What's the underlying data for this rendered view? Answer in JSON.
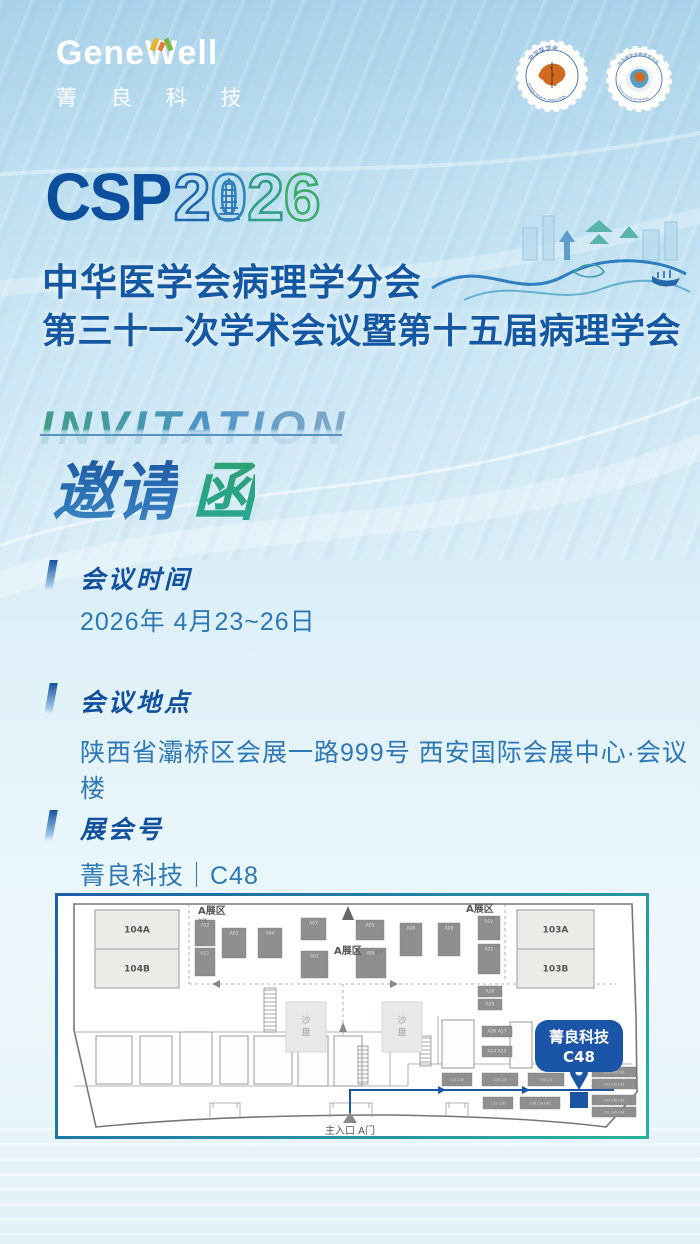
{
  "brand": {
    "logo_text": "GeneWell",
    "logo_sub": "菁 良 科 技"
  },
  "seals": {
    "left": {
      "top_text": "中华医学会",
      "arc_text": "CHINESE MEDICAL ASSOCIATION"
    },
    "right": {
      "top_text": "中华医学会病理学分会",
      "arc_text": "Chinese Society of Pathology"
    }
  },
  "hero": {
    "csp_text": "CSP",
    "year": [
      "2",
      "0",
      "2",
      "6"
    ],
    "title_line1": "中华医学会病理学分会",
    "title_line2": "第三十一次学术会议暨第十五届病理学会",
    "invitation_en": "INVITATION",
    "invitation_zh_1": "邀请",
    "invitation_zh_2": "函"
  },
  "sections": [
    {
      "title": "会议时间",
      "content": "2026年 4月23~26日"
    },
    {
      "title": "会议地点",
      "content": "陕西省灞桥区会展一路999号 西安国际会展中心·会议楼"
    },
    {
      "title": "展会号",
      "content": "菁良科技｜C48"
    }
  ],
  "map": {
    "zones": [
      {
        "text": "A展区",
        "sub": "左侧"
      },
      {
        "text": "A展区",
        "sub": "右侧"
      },
      {
        "text": "A展区",
        "sub": "展厅"
      }
    ],
    "rooms": [
      {
        "label": "104A",
        "x": 37,
        "y": 14,
        "w": 84,
        "h": 39
      },
      {
        "label": "104B",
        "x": 37,
        "y": 53,
        "w": 84,
        "h": 39
      },
      {
        "label": "103A",
        "x": 459,
        "y": 14,
        "w": 77,
        "h": 39
      },
      {
        "label": "103B",
        "x": 459,
        "y": 53,
        "w": 77,
        "h": 39
      }
    ],
    "booths_a": [
      {
        "x": 137,
        "y": 24,
        "w": 20,
        "h": 26,
        "l": "A12"
      },
      {
        "x": 137,
        "y": 52,
        "w": 20,
        "h": 28,
        "l": "A11"
      },
      {
        "x": 164,
        "y": 32,
        "w": 24,
        "h": 30,
        "l": "A03"
      },
      {
        "x": 200,
        "y": 32,
        "w": 24,
        "h": 30,
        "l": "A04"
      },
      {
        "x": 243,
        "y": 22,
        "w": 25,
        "h": 22,
        "l": "A07"
      },
      {
        "x": 243,
        "y": 55,
        "w": 27,
        "h": 27,
        "l": "A01"
      },
      {
        "x": 298,
        "y": 24,
        "w": 28,
        "h": 20,
        "l": "A05"
      },
      {
        "x": 298,
        "y": 52,
        "w": 30,
        "h": 30,
        "l": "A06"
      },
      {
        "x": 342,
        "y": 27,
        "w": 22,
        "h": 33,
        "l": "A08"
      },
      {
        "x": 380,
        "y": 27,
        "w": 22,
        "h": 33,
        "l": "A09"
      },
      {
        "x": 420,
        "y": 20,
        "w": 22,
        "h": 24,
        "l": "A02"
      },
      {
        "x": 420,
        "y": 48,
        "w": 22,
        "h": 30,
        "l": "A21"
      },
      {
        "x": 420,
        "y": 90,
        "w": 24,
        "h": 11,
        "l": "A30"
      },
      {
        "x": 420,
        "y": 103,
        "w": 24,
        "h": 11,
        "l": "A29"
      },
      {
        "x": 424,
        "y": 130,
        "w": 30,
        "h": 11,
        "l": "A26 A27"
      },
      {
        "x": 424,
        "y": 150,
        "w": 30,
        "h": 11,
        "l": "A24 A25"
      }
    ],
    "booths_c": [
      {
        "x": 384,
        "y": 177,
        "w": 30,
        "h": 13,
        "l": "C01 C02"
      },
      {
        "x": 424,
        "y": 177,
        "w": 36,
        "h": 13,
        "l": "C04 C05"
      },
      {
        "x": 470,
        "y": 177,
        "w": 36,
        "h": 13,
        "l": "C30 C31"
      },
      {
        "x": 534,
        "y": 171,
        "w": 44,
        "h": 10,
        "l": "C14 C45 C46"
      },
      {
        "x": 534,
        "y": 183,
        "w": 44,
        "h": 10,
        "l": "C43 C45 C47"
      },
      {
        "x": 425,
        "y": 201,
        "w": 30,
        "h": 12,
        "l": "C35 C36"
      },
      {
        "x": 462,
        "y": 201,
        "w": 40,
        "h": 12,
        "l": "C38 C39 C40"
      },
      {
        "x": 534,
        "y": 199,
        "w": 44,
        "h": 10,
        "l": "C47 C48 C43"
      },
      {
        "x": 534,
        "y": 211,
        "w": 44,
        "h": 10,
        "l": "C41 C42 C44"
      }
    ],
    "sand_tables": [
      {
        "x": 228,
        "y": 106,
        "w": 40,
        "h": 50
      },
      {
        "x": 324,
        "y": 106,
        "w": 40,
        "h": 50
      }
    ],
    "sand_label": "沙盘",
    "structures": [
      {
        "x": 38,
        "y": 140,
        "w": 36,
        "h": 48
      },
      {
        "x": 82,
        "y": 140,
        "w": 32,
        "h": 48
      },
      {
        "x": 122,
        "y": 136,
        "w": 32,
        "h": 52
      },
      {
        "x": 162,
        "y": 140,
        "w": 28,
        "h": 48
      },
      {
        "x": 196,
        "y": 140,
        "w": 38,
        "h": 48
      },
      {
        "x": 240,
        "y": 140,
        "w": 30,
        "h": 50
      },
      {
        "x": 276,
        "y": 140,
        "w": 28,
        "h": 50
      },
      {
        "x": 384,
        "y": 124,
        "w": 32,
        "h": 48
      },
      {
        "x": 452,
        "y": 126,
        "w": 22,
        "h": 46
      }
    ],
    "shafts": [
      {
        "x": 206,
        "y": 92,
        "w": 12,
        "h": 44
      },
      {
        "x": 300,
        "y": 150,
        "w": 10,
        "h": 38
      },
      {
        "x": 362,
        "y": 140,
        "w": 11,
        "h": 30
      }
    ],
    "doors": [
      {
        "x": 152,
        "w": 30
      },
      {
        "x": 272,
        "w": 42
      },
      {
        "x": 388,
        "w": 22
      }
    ],
    "entrance_label": "主入口 A门",
    "badge": {
      "line1": "菁良科技",
      "line2": "C48"
    }
  },
  "colors": {
    "accent_blue": "#15549f",
    "accent_green": "#2fae7e",
    "badge_blue": "#1b55a8",
    "map_border_start": "#1d5fa8",
    "map_border_end": "#28b29a"
  }
}
